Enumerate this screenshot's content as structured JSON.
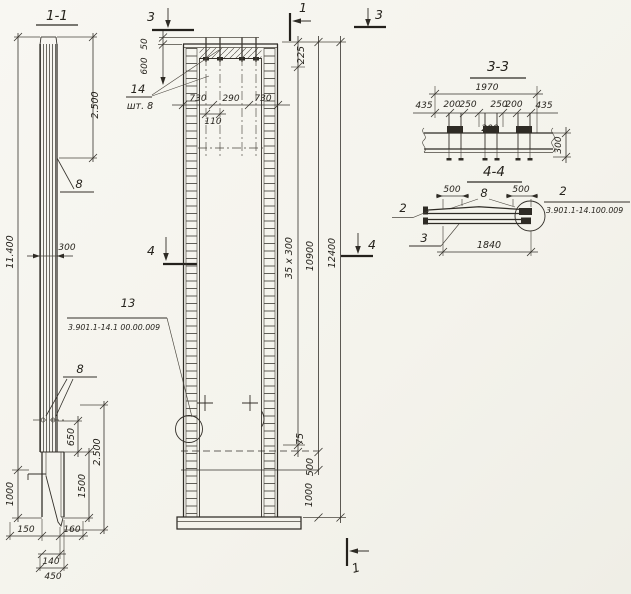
{
  "colors": {
    "paper": "#f6f5f0",
    "ink": "#2e2b25"
  },
  "views": {
    "section11": {
      "title": "1-1",
      "dim_total": "11.400",
      "dim_top_2500": "2.500",
      "label_rebar_top": "8",
      "dim_width_300": "300",
      "label_rebar_bottom": "8",
      "dim_650": "650",
      "dim_1500": "1500",
      "dim_bottom_2500": "2.500",
      "dim_1000": "1000",
      "dim_150": "150",
      "dim_160": "160",
      "dim_140": "140",
      "dim_450": "450"
    },
    "elevation": {
      "mark_3_top_left": "3",
      "mark_1_top": "1",
      "mark_3_top_right": "3",
      "mark_4_left": "4",
      "mark_4_right": "4",
      "mark_1_bottom": "1",
      "dim_50": "50",
      "dim_600": "600",
      "label_14": "14",
      "label_14_qty": "шт. 8",
      "dim_730_left": "730",
      "dim_290": "290",
      "dim_730_right": "730",
      "dim_110": "110",
      "dim_225": "225",
      "dim_35x300": "35 x 300",
      "dim_10900": "10900",
      "dim_12400": "12400",
      "dim_75": "75",
      "dim_500": "500",
      "dim_1000": "1000",
      "label_13": "13",
      "label_13_doc": "3.901.1-14.1 00.00.009"
    },
    "section33": {
      "title": "3-3",
      "dim_1970": "1970",
      "dim_435_l": "435",
      "dim_200_l": "200",
      "dim_250_l": "250",
      "dim_250_r": "250",
      "dim_200_r": "200",
      "dim_435_r": "435",
      "dim_200_c": "200",
      "dim_300": "300"
    },
    "section44": {
      "title": "4-4",
      "dim_500_l": "500",
      "dim_500_r": "500",
      "label_8": "8",
      "label_2_left": "2",
      "label_3": "3",
      "dim_1840": "1840",
      "label_2_right": "2",
      "label_2_doc": "3.901.1-14.100.009"
    }
  }
}
